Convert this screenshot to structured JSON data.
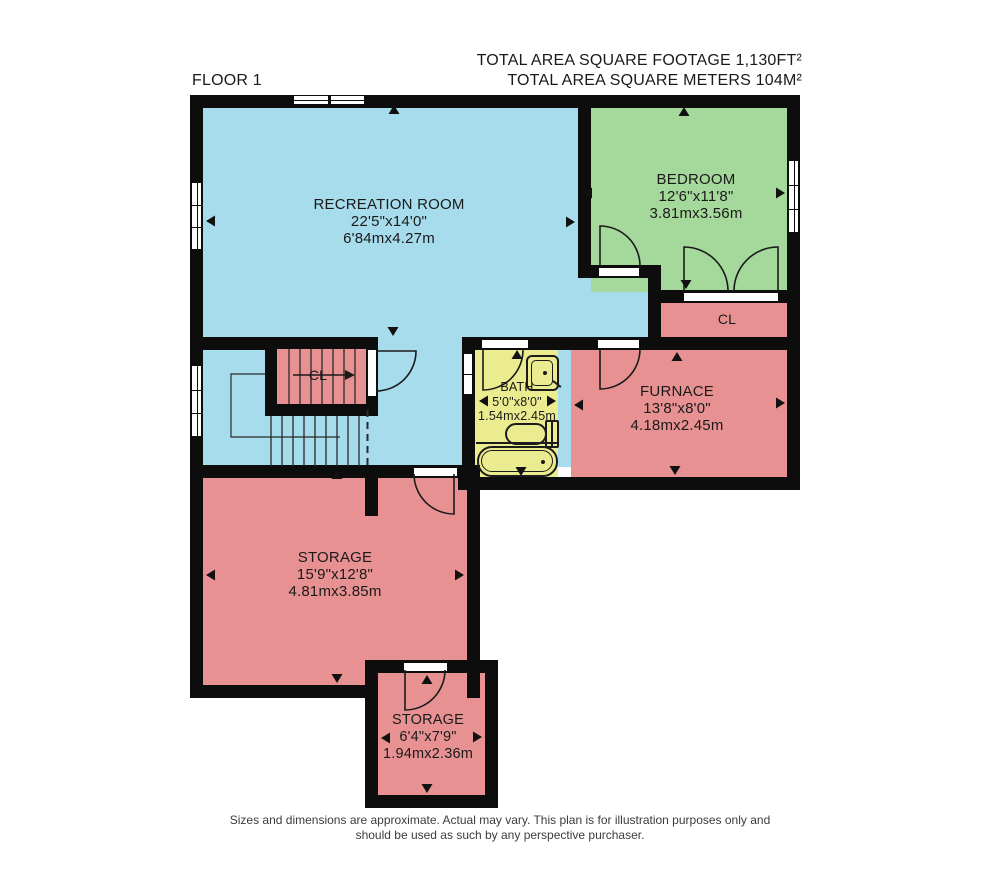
{
  "title": {
    "floor_label": "FLOOR 1",
    "area_ft_label": "TOTAL AREA SQUARE FOOTAGE 1,130FT²",
    "area_m_label": "TOTAL AREA SQUARE METERS 104M²"
  },
  "rooms": {
    "recreation": {
      "name": "RECREATION ROOM",
      "size_imperial": "22'5\"x14'0\"",
      "size_metric": "6'84mx4.27m"
    },
    "bedroom": {
      "name": "BEDROOM",
      "size_imperial": "12'6\"x11'8\"",
      "size_metric": "3.81mx3.56m"
    },
    "closet": {
      "name": "CL"
    },
    "stairs_closet": {
      "name": "CL"
    },
    "furnace": {
      "name": "FURNACE",
      "size_imperial": "13'8\"x8'0\"",
      "size_metric": "4.18mx2.45m"
    },
    "bath": {
      "name": "BATH",
      "size_imperial": "5'0\"x8'0\"",
      "size_metric": "1.54mx2.45m"
    },
    "storage_main": {
      "name": "STORAGE",
      "size_imperial": "15'9\"x12'8\"",
      "size_metric": "4.81mx3.85m"
    },
    "storage_small": {
      "name": "STORAGE",
      "size_imperial": "6'4\"x7'9\"",
      "size_metric": "1.94mx2.36m"
    }
  },
  "colors": {
    "wall": "#0d0d0d",
    "recreation_blue": "#a6dcec",
    "bedroom_green": "#a5d89b",
    "utility_pink": "#e89192",
    "bath_yellow": "#ebeb90"
  },
  "footer": {
    "disclaimer_line1": "Sizes and dimensions are approximate. Actual may vary. This plan is for illustration purposes only and",
    "disclaimer_line2": "should be used as such by any perspective purchaser."
  }
}
